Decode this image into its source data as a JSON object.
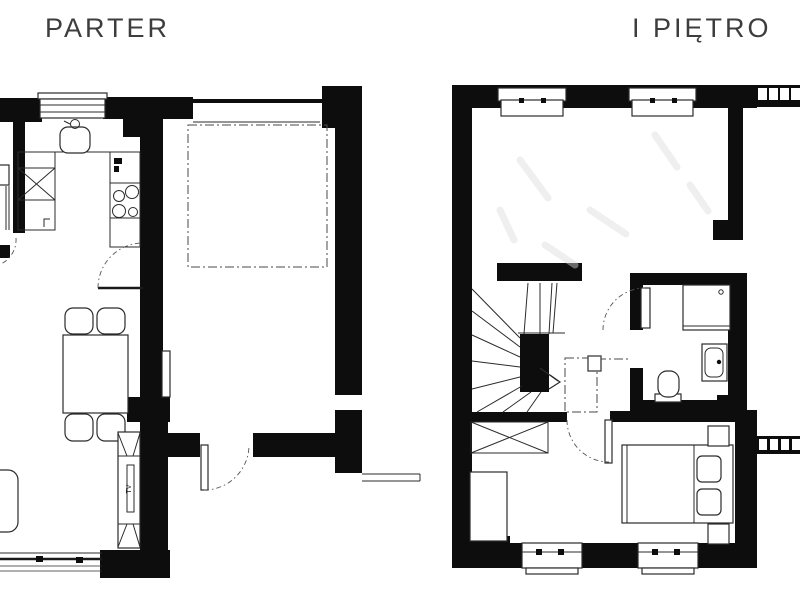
{
  "page": {
    "type": "architectural-floor-plan",
    "background": "#ffffff"
  },
  "colors": {
    "wall": "#0d0d0d",
    "line": "#2b2b2b",
    "label": "#3d3d3d",
    "dash": "#4a4a4a"
  },
  "floors": [
    {
      "id": "parter",
      "label": "PARTER",
      "features": [
        "kitchen-sink-icon",
        "stove-burners-icon",
        "fridge-x-icon",
        "kitchen-cabinets",
        "dining-table",
        "chairs-x4",
        "sofa",
        "tv-cabinet",
        "garage-dashed-outline",
        "window-top",
        "window-bottom",
        "door-swing-kitchen",
        "door-swing-garage",
        "door-swing-left"
      ]
    },
    {
      "id": "pietro",
      "label": "I PIĘTRO",
      "features": [
        "winder-staircase",
        "stair-direction-arrow",
        "floor-opening-dashed-outline",
        "chimney",
        "void-x-box",
        "wardrobe",
        "bathroom-shower",
        "bathroom-washbasin",
        "bathroom-toilet",
        "double-bed",
        "pillows-x2",
        "nightstands-x2",
        "windows-top-x2",
        "windows-bottom-x2",
        "balcony-railing-top",
        "balcony-railing-right",
        "door-swing-bathroom",
        "door-swing-bedroom"
      ]
    }
  ],
  "tv_cabinet": {
    "label": "TV"
  }
}
